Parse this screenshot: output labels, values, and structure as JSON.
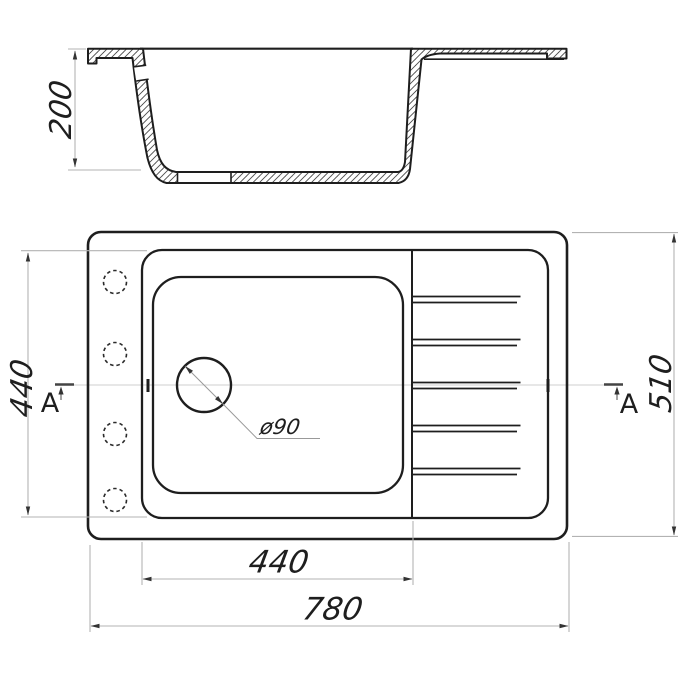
{
  "drawing": {
    "title_hint": "sink-technical-drawing",
    "colors": {
      "background": "#ffffff",
      "main_line": "#1e1e1e",
      "faint_line": "#b3b3b3",
      "hatch_line": "#4a4a4a"
    },
    "section_view": {
      "depth_dim": "200"
    },
    "plan_view": {
      "bowl_depth_dim": "440",
      "bowl_width_dim": "440",
      "overall_width_dim": "780",
      "overall_depth_dim": "510",
      "drain_diameter_label": "ø90",
      "section_label_left": "A",
      "section_label_right": "A"
    }
  }
}
